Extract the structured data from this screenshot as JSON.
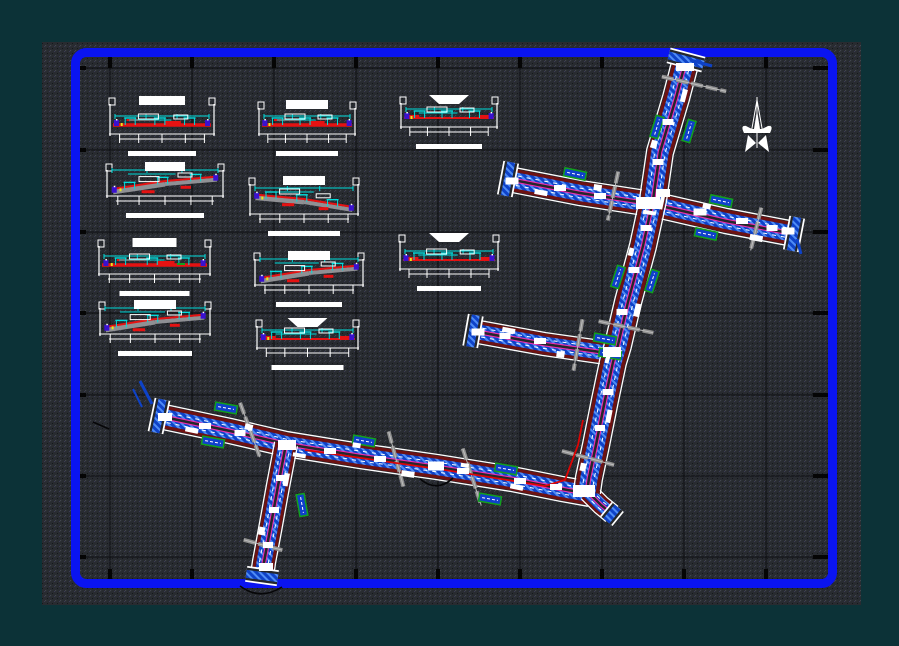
{
  "document": {
    "kind": "cad-road-plan-and-sections-drawing",
    "visible_text": "none-legible (annotation text rendered as raster blobs)"
  },
  "colors": {
    "bg": "#0c3237",
    "panel": "#282b30",
    "panel_dot_light": "#41464d",
    "panel_dot_dark": "#15171b",
    "panel_dot_tint": "#3a3a55",
    "frame": "#0a14f0",
    "grid": "#0b0c0f",
    "tick": "#050505",
    "white": "#ffffff",
    "road_bg": "#24272c",
    "curb": "#6e1212",
    "road_blue": "#0e42c8",
    "road_blue_light": "#4f8cf5",
    "magenta": "#ee2fae",
    "marker": "#8f8f8f",
    "patch_fill": "#1040cc",
    "patch_green": "#12a01e",
    "node": "#3a11d0",
    "cyan": "#00dcdc",
    "red": "#e51212",
    "band": "#8f9094",
    "yellow": "#e8e81a",
    "route": "#dd0505",
    "black": "#060608"
  },
  "sheet": {
    "panel": {
      "x": 42,
      "y": 42,
      "w": 819,
      "h": 563
    },
    "frame": {
      "x": 75.5,
      "y": 52.5,
      "w": 757,
      "h": 531,
      "rx": 11,
      "sw": 9
    }
  },
  "grid": {
    "xs": [
      110,
      192,
      274,
      356,
      438,
      520,
      602,
      684,
      766
    ],
    "ys": [
      68,
      150,
      232,
      313,
      395,
      476,
      557
    ],
    "x_span": [
      80,
      829
    ],
    "y_span": [
      58,
      579
    ]
  },
  "roads": [
    {
      "name": "cross-street-north",
      "pts": [
        [
          508,
          179
        ],
        [
          580,
          193
        ],
        [
          652,
          204
        ],
        [
          726,
          221
        ],
        [
          794,
          234
        ]
      ],
      "width": 26
    },
    {
      "name": "branch-street-west",
      "pts": [
        [
          473,
          331
        ],
        [
          544,
          344
        ],
        [
          614,
          354
        ]
      ],
      "width": 24
    },
    {
      "name": "lower-avenue",
      "pts": [
        [
          159,
          416
        ],
        [
          230,
          431
        ],
        [
          286,
          444
        ],
        [
          360,
          456
        ],
        [
          437,
          467
        ],
        [
          512,
          479
        ],
        [
          562,
          489
        ],
        [
          590,
          494
        ]
      ],
      "width": 26
    },
    {
      "name": "south-branch",
      "pts": [
        [
          286,
          444
        ],
        [
          278,
          486
        ],
        [
          270,
          530
        ],
        [
          264,
          562
        ],
        [
          262,
          576
        ]
      ],
      "width": 24
    },
    {
      "name": "elbow-stub",
      "pts": [
        [
          588,
          492
        ],
        [
          601,
          505
        ],
        [
          612,
          514
        ]
      ],
      "width": 20,
      "nodeco": true
    },
    {
      "name": "main-avenue",
      "pts": [
        [
          686,
          60
        ],
        [
          676,
          98
        ],
        [
          660,
          152
        ],
        [
          653,
          200
        ],
        [
          643,
          246
        ],
        [
          628,
          302
        ],
        [
          618,
          345
        ],
        [
          613,
          362
        ],
        [
          605,
          400
        ],
        [
          596,
          445
        ],
        [
          589,
          478
        ],
        [
          587,
          492
        ]
      ],
      "width": 28
    }
  ],
  "flares": [
    {
      "x": 686,
      "y": 60,
      "angle": 14.7,
      "len": 36
    },
    {
      "x": 508,
      "y": 179,
      "angle": 101,
      "len": 34
    },
    {
      "x": 794,
      "y": 234,
      "angle": 101,
      "len": 34
    },
    {
      "x": 473,
      "y": 331,
      "angle": 100,
      "len": 32
    },
    {
      "x": 159,
      "y": 416,
      "angle": 102,
      "len": 34
    },
    {
      "x": 262,
      "y": 576,
      "angle": 8,
      "len": 32
    },
    {
      "x": 612,
      "y": 514,
      "angle": 129,
      "len": 18
    }
  ],
  "route_highlight": {
    "pts": [
      [
        305,
        450
      ],
      [
        445,
        470
      ],
      [
        545,
        486
      ],
      [
        565,
        480
      ],
      [
        578,
        445
      ],
      [
        583,
        420
      ]
    ]
  },
  "cut_markers": [
    [
      694,
      84,
      13,
      66
    ],
    [
      613,
      196,
      102,
      50
    ],
    [
      756,
      229,
      104,
      44
    ],
    [
      626,
      327,
      12,
      56
    ],
    [
      578,
      345,
      100,
      52
    ],
    [
      588,
      458,
      15,
      54
    ],
    [
      396,
      459,
      75,
      57
    ],
    [
      250,
      430,
      70,
      58
    ],
    [
      263,
      545,
      15,
      40
    ],
    [
      472,
      477,
      72,
      60
    ]
  ],
  "side_patches": [
    [
      657,
      127,
      -73
    ],
    [
      689,
      131,
      -73
    ],
    [
      618,
      277,
      -72
    ],
    [
      652,
      281,
      -72
    ],
    [
      575,
      174,
      12
    ],
    [
      721,
      201,
      12
    ],
    [
      706,
      234,
      12
    ],
    [
      605,
      339,
      10
    ],
    [
      610,
      354,
      10
    ],
    [
      226,
      408,
      10
    ],
    [
      364,
      441,
      10
    ],
    [
      213,
      442,
      10
    ],
    [
      506,
      469,
      10
    ],
    [
      490,
      499,
      10
    ],
    [
      302,
      505,
      80
    ]
  ],
  "labels": [
    [
      648,
      203,
      24,
      12
    ],
    [
      663,
      193,
      14,
      8
    ],
    [
      612,
      352,
      18,
      10
    ],
    [
      287,
      445,
      18,
      10
    ],
    [
      584,
      491,
      22,
      12
    ],
    [
      685,
      67,
      18,
      8
    ],
    [
      512,
      181,
      13,
      7
    ],
    [
      788,
      231,
      13,
      7
    ],
    [
      478,
      332,
      13,
      7
    ],
    [
      266,
      567,
      14,
      8
    ],
    [
      165,
      417,
      14,
      8
    ],
    [
      436,
      466,
      16,
      9
    ],
    [
      600,
      428,
      10,
      6
    ],
    [
      608,
      392,
      11,
      6
    ],
    [
      622,
      312,
      11,
      6
    ],
    [
      634,
      270,
      11,
      6
    ],
    [
      646,
      228,
      11,
      6
    ],
    [
      658,
      162,
      11,
      6
    ],
    [
      668,
      122,
      11,
      6
    ],
    [
      560,
      188,
      12,
      6
    ],
    [
      600,
      196,
      12,
      6
    ],
    [
      700,
      212,
      13,
      7
    ],
    [
      742,
      221,
      12,
      6
    ],
    [
      772,
      228,
      11,
      6
    ],
    [
      540,
      341,
      12,
      6
    ],
    [
      505,
      336,
      11,
      6
    ],
    [
      330,
      451,
      12,
      6
    ],
    [
      380,
      459,
      12,
      6
    ],
    [
      463,
      471,
      12,
      6
    ],
    [
      520,
      481,
      12,
      6
    ],
    [
      556,
      487,
      12,
      6
    ],
    [
      205,
      426,
      12,
      6
    ],
    [
      240,
      433,
      11,
      6
    ],
    [
      281,
      478,
      10,
      6
    ],
    [
      274,
      510,
      10,
      6
    ],
    [
      268,
      545,
      10,
      6
    ]
  ],
  "deco": {
    "step": 55,
    "min_len": 8
  },
  "sections": [
    {
      "x": 103,
      "y": 92,
      "w": 118,
      "h": 56,
      "t": "D",
      "tw": 46,
      "sw": 68
    },
    {
      "x": 252,
      "y": 96,
      "w": 110,
      "h": 52,
      "t": "D",
      "tw": 42,
      "sw": 62
    },
    {
      "x": 394,
      "y": 91,
      "w": 110,
      "h": 50,
      "t": "A",
      "tw": 40,
      "sw": 66,
      "shape": "trap"
    },
    {
      "x": 100,
      "y": 158,
      "w": 130,
      "h": 52,
      "t": "B",
      "tw": 40,
      "sw": 78
    },
    {
      "x": 243,
      "y": 172,
      "w": 122,
      "h": 56,
      "t": "C",
      "tw": 42,
      "sw": 72
    },
    {
      "x": 92,
      "y": 234,
      "w": 125,
      "h": 54,
      "t": "D",
      "tw": 44,
      "sw": 70,
      "green": true
    },
    {
      "x": 248,
      "y": 247,
      "w": 122,
      "h": 52,
      "t": "B",
      "tw": 42,
      "sw": 66
    },
    {
      "x": 393,
      "y": 229,
      "w": 112,
      "h": 54,
      "t": "A",
      "tw": 40,
      "sw": 64,
      "shape": "trap"
    },
    {
      "x": 93,
      "y": 296,
      "w": 124,
      "h": 52,
      "t": "B",
      "tw": 42,
      "sw": 74
    },
    {
      "x": 250,
      "y": 314,
      "w": 115,
      "h": 48,
      "t": "A",
      "tw": 40,
      "sw": 72,
      "shape": "trap"
    }
  ],
  "north_arrow": {
    "x": 757,
    "y": 97
  },
  "blue_stubs": [
    {
      "pts": [
        [
          140,
          381
        ],
        [
          152,
          404
        ]
      ],
      "w": 3
    },
    {
      "pts": [
        [
          133,
          389
        ],
        [
          142,
          407
        ]
      ],
      "w": 2
    },
    {
      "pts": [
        [
          690,
          60
        ],
        [
          712,
          66
        ]
      ],
      "w": 3
    },
    {
      "pts": [
        [
          797,
          239
        ],
        [
          801,
          254
        ]
      ],
      "w": 3
    }
  ],
  "black_marks": [
    "M240,586 Q260,601 282,587",
    "M420,479 Q437,493 453,478",
    "M93,422 l16,7"
  ]
}
